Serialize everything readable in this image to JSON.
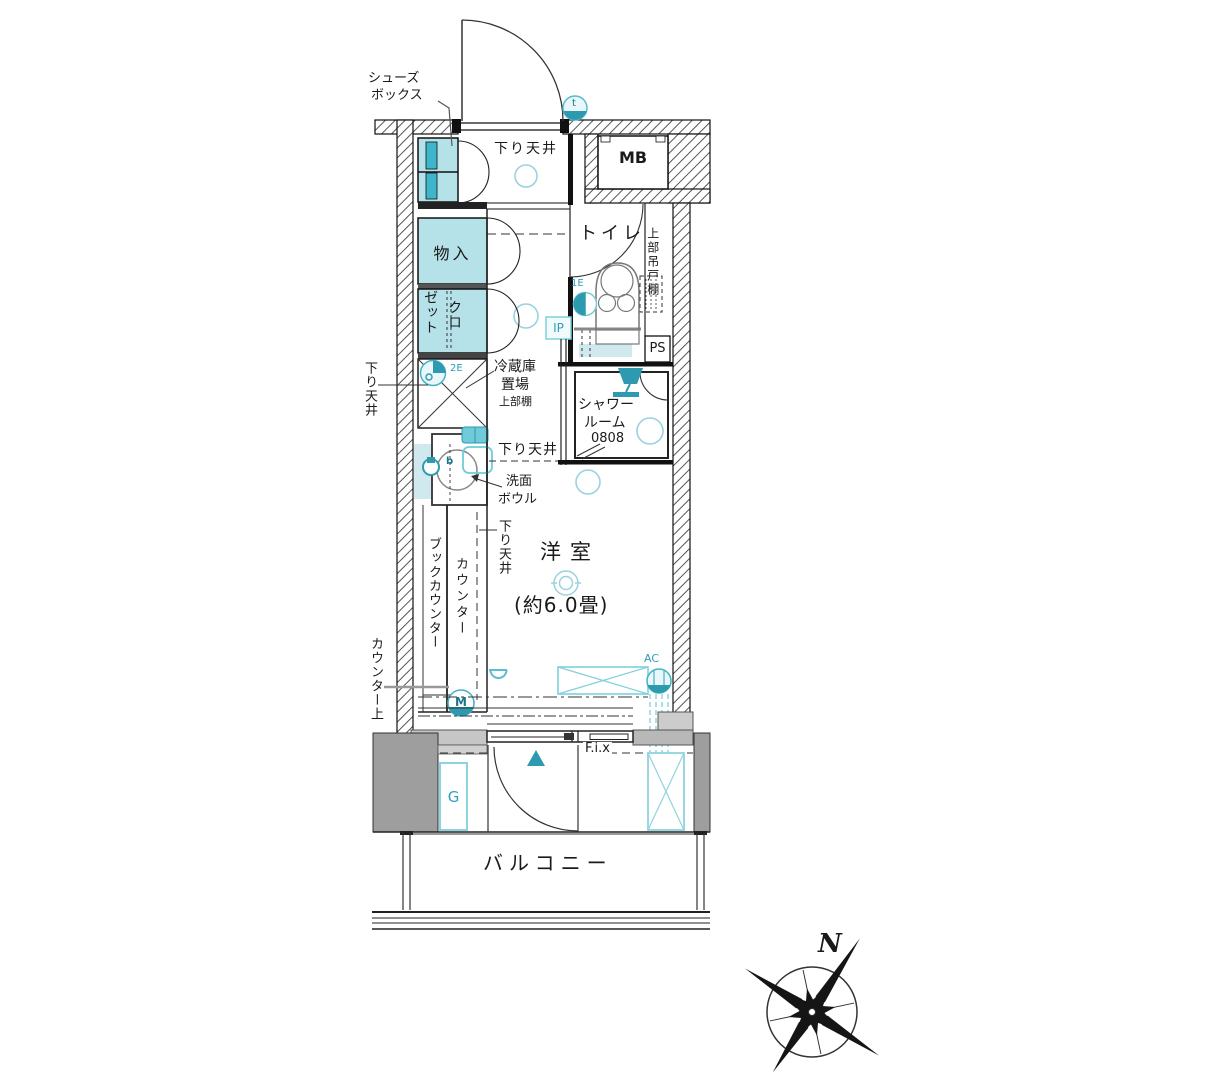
{
  "plan_title": "1K floor plan",
  "labels": {
    "shoebox1": "シューズ",
    "shoebox2": "ボックス",
    "lowered_ceiling": "下り天井",
    "mb": "MB",
    "toilet": "トイレ",
    "upper_cabinet": "上部吊戸棚",
    "ps": "PS",
    "storage": "物入",
    "closet_kuro": "クロ",
    "closet_zetto": "ゼット",
    "fridge1": "冷蔵庫",
    "fridge2": "置場",
    "fridge3": "上部棚",
    "shower1": "シャワー",
    "shower2": "ルーム",
    "shower3": "0808",
    "wash1": "洗面",
    "wash2": "ボウル",
    "room_name": "洋室",
    "room_size": "(約6.0畳)",
    "book_counter": "ブックカウンター",
    "counter": "カウンター",
    "counter_top": "カウンター上",
    "balcony": "バルコニー",
    "fix": "F.i.x"
  },
  "marks": {
    "t": "t",
    "ip": "IP",
    "e1": "1E",
    "e2": "2E",
    "b": "b",
    "m": "M",
    "g": "G",
    "ac": "AC",
    "north": "N"
  },
  "colors": {
    "accent_cyan": "#2e9ab0",
    "light_cyan_fill": "#b5e1e8",
    "pale_cyan_fill": "#cfe9ef",
    "wall_gray": "#9e9e9e",
    "line": "#1a1a1a"
  }
}
